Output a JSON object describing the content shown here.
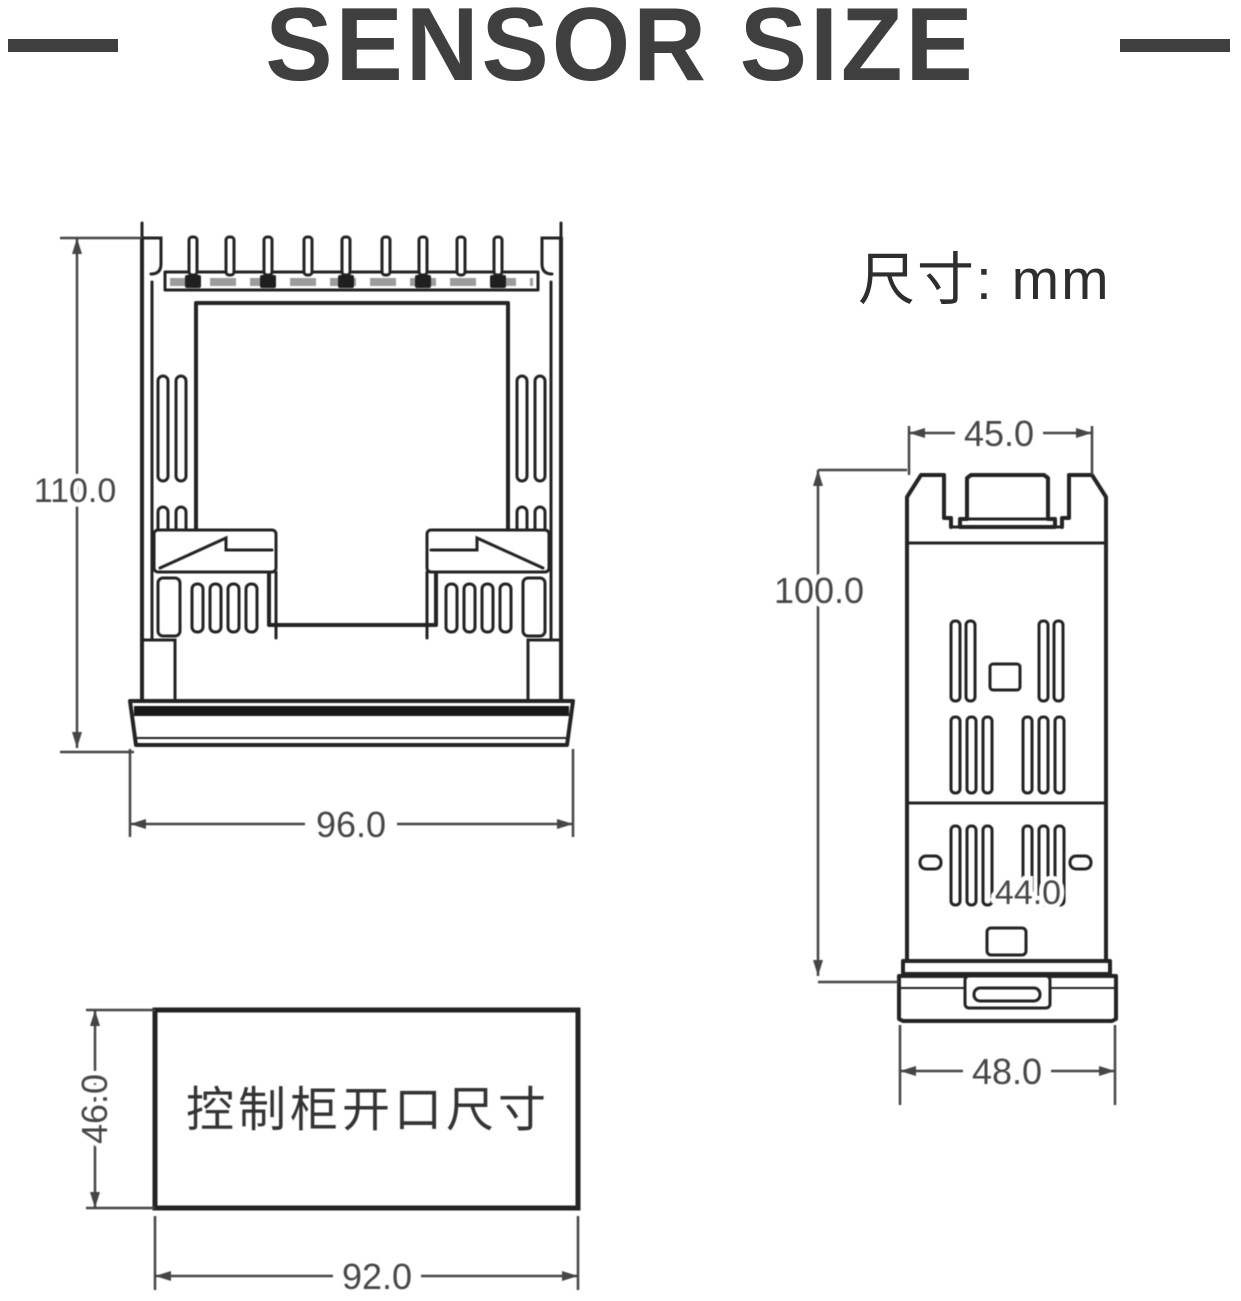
{
  "title": "SENSOR SIZE",
  "unit_label": "尺寸: mm",
  "views": {
    "rear": {
      "height_mm": "110.0",
      "width_mm": "96.0"
    },
    "side": {
      "top_width_mm": "45.0",
      "height_mm": "100.0",
      "mid_width_mm": "44.0",
      "bottom_width_mm": "48.0"
    },
    "cutout": {
      "label": "控制柜开口尺寸",
      "height_mm": "46.0",
      "width_mm": "92.0"
    }
  },
  "colors": {
    "line": "#232323",
    "dim": "#454545",
    "title": "#3f3f3f",
    "band": "#181818"
  }
}
